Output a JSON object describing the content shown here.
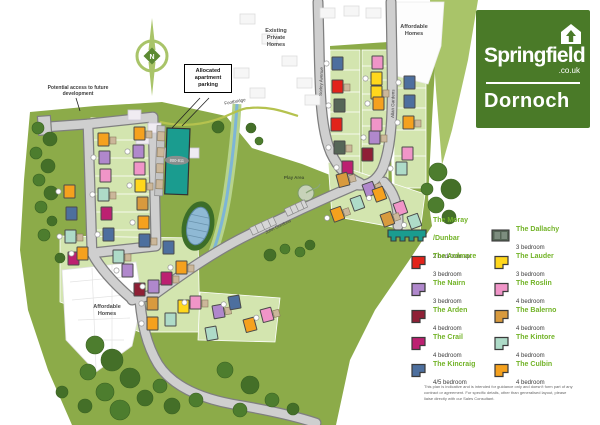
{
  "logo": {
    "brand": "Springfield",
    "tld": ".co.uk",
    "development": "Dornoch"
  },
  "compass": {
    "letter": "N"
  },
  "map_labels": {
    "potential_access": "Potential access to future development",
    "allocated_apartment_parking": "Allocated apartment parking",
    "footbridge": "Footbridge",
    "existing_private_homes": "Existing Private Homes",
    "affordable_homes_top": "Affordable Homes",
    "affordable_homes_bottom": "Affordable Homes",
    "play_area": "Play Area"
  },
  "streets": {
    "sorley": "Sorley Avenue",
    "allan": "Allan Gardens",
    "spine": "John Gordons"
  },
  "apartment": {
    "plots": "800-811",
    "color": "#1a9c8f"
  },
  "legend": {
    "items": [
      {
        "name": "The Moray /Dunbar",
        "desc": "2 bedroom apt",
        "color": "#1a9c8f",
        "shape": "terrace"
      },
      {
        "name": "The Dallachy",
        "desc": "3 bedroom",
        "color": "#566657",
        "shape": "duo"
      },
      {
        "name": "The Ardmore",
        "desc": "3 bedroom",
        "color": "#e2231a",
        "shape": "footprint"
      },
      {
        "name": "The Lauder",
        "desc": "3 bedroom",
        "color": "#ffd71c",
        "shape": "footprint"
      },
      {
        "name": "The Nairn",
        "desc": "3 bedroom",
        "color": "#b088cc",
        "shape": "footprint"
      },
      {
        "name": "The Roslin",
        "desc": "4 bedroom",
        "color": "#f095c8",
        "shape": "footprint"
      },
      {
        "name": "The Arden",
        "desc": "4 bedroom",
        "color": "#8f2036",
        "shape": "footprint"
      },
      {
        "name": "The Balerno",
        "desc": "4 bedroom",
        "color": "#d89a3e",
        "shape": "footprint"
      },
      {
        "name": "The Crail",
        "desc": "4 bedroom",
        "color": "#bc2071",
        "shape": "footprint"
      },
      {
        "name": "The Kintore",
        "desc": "4 bedroom",
        "color": "#aedbc8",
        "shape": "footprint"
      },
      {
        "name": "The Kincraig",
        "desc": "4/5 bedroom",
        "color": "#4d6f9e",
        "shape": "footprint"
      },
      {
        "name": "The Culbin",
        "desc": "4 bedroom",
        "color": "#f5a11e",
        "shape": "footprint"
      }
    ],
    "disclaimer": "This plan is indicative and is intended for guidance only and doesn't form part of any contract or agreement. For specific details, other than generalised layout, please liaise directly with our Sales Consultant."
  },
  "map": {
    "houses": [
      [
        98,
        133,
        11
      ],
      [
        99,
        151,
        4
      ],
      [
        100,
        169,
        5
      ],
      [
        98,
        188,
        9
      ],
      [
        101,
        207,
        8
      ],
      [
        103,
        228,
        10
      ],
      [
        134,
        127,
        11
      ],
      [
        133,
        145,
        4
      ],
      [
        134,
        162,
        5
      ],
      [
        135,
        179,
        3
      ],
      [
        137,
        197,
        7
      ],
      [
        138,
        216,
        11
      ],
      [
        139,
        234,
        10
      ],
      [
        64,
        185,
        11
      ],
      [
        66,
        207,
        10
      ],
      [
        65,
        230,
        9
      ],
      [
        68,
        252,
        8
      ],
      [
        77,
        247,
        11
      ],
      [
        113,
        250,
        9
      ],
      [
        122,
        264,
        4
      ],
      [
        163,
        241,
        10
      ],
      [
        176,
        261,
        11
      ],
      [
        134,
        283,
        6
      ],
      [
        148,
        280,
        4
      ],
      [
        161,
        272,
        8
      ],
      [
        147,
        297,
        7
      ],
      [
        178,
        300,
        3
      ],
      [
        190,
        296,
        5
      ],
      [
        165,
        313,
        9
      ],
      [
        147,
        317,
        11
      ],
      [
        212,
        306,
        4,
        -10
      ],
      [
        228,
        297,
        10,
        -10
      ],
      [
        243,
        320,
        11,
        -15
      ],
      [
        260,
        310,
        5,
        -15
      ],
      [
        205,
        328,
        9,
        -10
      ],
      [
        332,
        57,
        10
      ],
      [
        332,
        80,
        2
      ],
      [
        334,
        99,
        1
      ],
      [
        331,
        118,
        2
      ],
      [
        334,
        141,
        1
      ],
      [
        372,
        56,
        5
      ],
      [
        371,
        72,
        3
      ],
      [
        371,
        86,
        3
      ],
      [
        373,
        97,
        11
      ],
      [
        371,
        118,
        5
      ],
      [
        369,
        131,
        4
      ],
      [
        362,
        148,
        6
      ],
      [
        342,
        161,
        8
      ],
      [
        336,
        175,
        7,
        -15
      ],
      [
        404,
        76,
        10
      ],
      [
        404,
        95,
        10
      ],
      [
        403,
        116,
        11
      ],
      [
        402,
        147,
        5
      ],
      [
        396,
        162,
        9
      ],
      [
        362,
        185,
        4,
        -20
      ],
      [
        372,
        190,
        11,
        -20
      ],
      [
        350,
        199,
        9,
        -20
      ],
      [
        330,
        210,
        11,
        -20
      ],
      [
        393,
        204,
        5,
        -20
      ],
      [
        407,
        217,
        9,
        -20
      ],
      [
        380,
        215,
        7,
        -20
      ]
    ],
    "trees": [
      [
        38,
        128,
        6
      ],
      [
        50,
        139,
        7
      ],
      [
        36,
        153,
        6
      ],
      [
        48,
        166,
        7
      ],
      [
        39,
        180,
        6
      ],
      [
        51,
        193,
        7
      ],
      [
        41,
        207,
        6
      ],
      [
        52,
        221,
        5
      ],
      [
        44,
        235,
        6
      ],
      [
        60,
        258,
        5
      ],
      [
        95,
        345,
        9
      ],
      [
        112,
        360,
        11
      ],
      [
        88,
        372,
        8
      ],
      [
        130,
        378,
        10
      ],
      [
        105,
        392,
        9
      ],
      [
        145,
        398,
        8
      ],
      [
        120,
        410,
        10
      ],
      [
        85,
        406,
        7
      ],
      [
        160,
        386,
        7
      ],
      [
        172,
        406,
        8
      ],
      [
        196,
        400,
        7
      ],
      [
        62,
        392,
        6
      ],
      [
        225,
        370,
        8
      ],
      [
        250,
        385,
        9
      ],
      [
        272,
        400,
        7
      ],
      [
        293,
        409,
        6
      ],
      [
        240,
        410,
        7
      ],
      [
        270,
        255,
        6
      ],
      [
        285,
        249,
        5
      ],
      [
        310,
        245,
        5
      ],
      [
        438,
        172,
        9
      ],
      [
        451,
        189,
        10
      ],
      [
        436,
        205,
        8
      ],
      [
        449,
        217,
        7
      ],
      [
        427,
        189,
        6
      ],
      [
        251,
        128,
        5
      ],
      [
        259,
        141,
        4
      ],
      [
        218,
        127,
        6
      ],
      [
        300,
        252,
        5
      ]
    ],
    "ghost_future": [
      [
        128,
        110
      ],
      [
        148,
        123
      ],
      [
        168,
        136
      ],
      [
        186,
        148
      ],
      [
        136,
        134
      ],
      [
        156,
        148
      ]
    ],
    "ghost_existing": [
      [
        240,
        14
      ],
      [
        262,
        34
      ],
      [
        282,
        56
      ],
      [
        297,
        78
      ],
      [
        320,
        8
      ],
      [
        344,
        6
      ],
      [
        366,
        8
      ],
      [
        250,
        88
      ],
      [
        234,
        68
      ],
      [
        305,
        95
      ]
    ]
  }
}
